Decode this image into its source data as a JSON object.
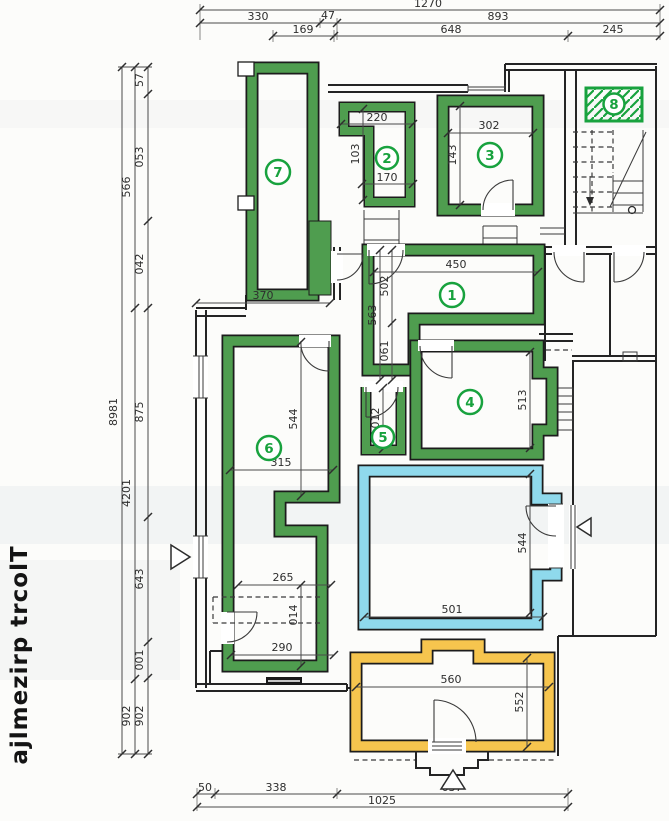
{
  "title": "Tlocrt prizemlja",
  "colors": {
    "wall_green": "#4f9d4f",
    "label_green": "#18a23e",
    "wall_blue": "#8fd9ec",
    "wall_yellow": "#f6c54e",
    "line": "#242424"
  },
  "rooms": {
    "r1": "1",
    "r2": "2",
    "r3": "3",
    "r4": "4",
    "r5": "5",
    "r6": "6",
    "r7": "7",
    "r8": "8"
  },
  "dims": {
    "top_total": "1270",
    "top_a": "330",
    "top_b": "47",
    "top_c": "893",
    "top_d": "169",
    "top_e": "648",
    "top_f": "245",
    "left_total": "1898",
    "left_a": "665",
    "left_b": "1024",
    "left_c": "209",
    "left_d": "75",
    "left_e": "350",
    "left_f": "240",
    "left_g": "578",
    "left_h": "346",
    "left_i": "100",
    "left_j": "209",
    "bottom_a": "50",
    "bottom_b": "338",
    "bottom_c": "637",
    "bottom_total": "1025",
    "r7_w": "370",
    "r2_top": "220",
    "r2_h": "301",
    "r2_w": "170",
    "r3_w": "302",
    "r3_h": "341",
    "r1_w": "450",
    "r1_h1": "205",
    "r1_h2": "365",
    "r1_h3": "160",
    "r4_h": "315",
    "r5_h": "210",
    "r6_h1": "445",
    "r6_w1": "315",
    "r6_w2": "265",
    "r6_h2": "410",
    "r6_w3": "290",
    "blue_w": "501",
    "blue_h": "445",
    "yellow_w": "560",
    "yellow_h": "255"
  }
}
